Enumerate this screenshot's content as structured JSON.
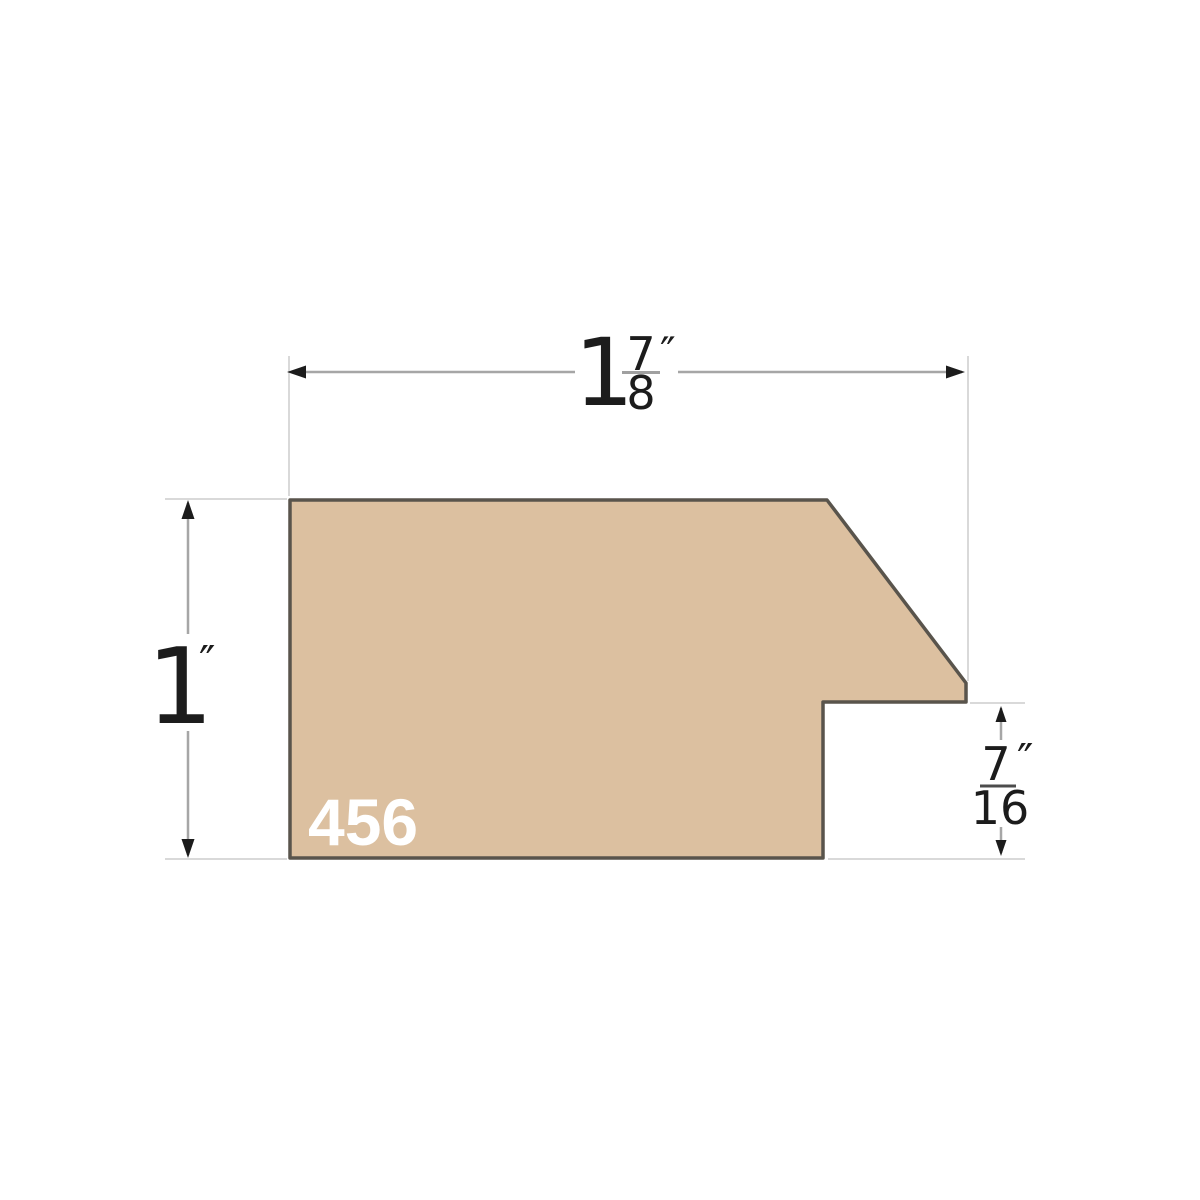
{
  "profile": {
    "number": "456",
    "fill_color": "#dcc0a0",
    "outline_color": "#59544c",
    "number_color": "#ffffff"
  },
  "dimensions": {
    "width": {
      "whole": "1",
      "numerator": "7",
      "denominator": "8",
      "unit": "″"
    },
    "height": {
      "whole": "1",
      "unit": "″"
    },
    "rabbet": {
      "numerator": "7",
      "denominator": "16",
      "unit": "″"
    }
  },
  "colors": {
    "background": "#ffffff",
    "dimension_line": "#a6a6a6",
    "extension_line": "#d9d9d9",
    "arrowhead": "#1c1c1c",
    "label_text": "#1c1c1c",
    "fraction_bar_width": "#a0a0a0",
    "fraction_bar_rabbet": "#4c4c4c"
  }
}
